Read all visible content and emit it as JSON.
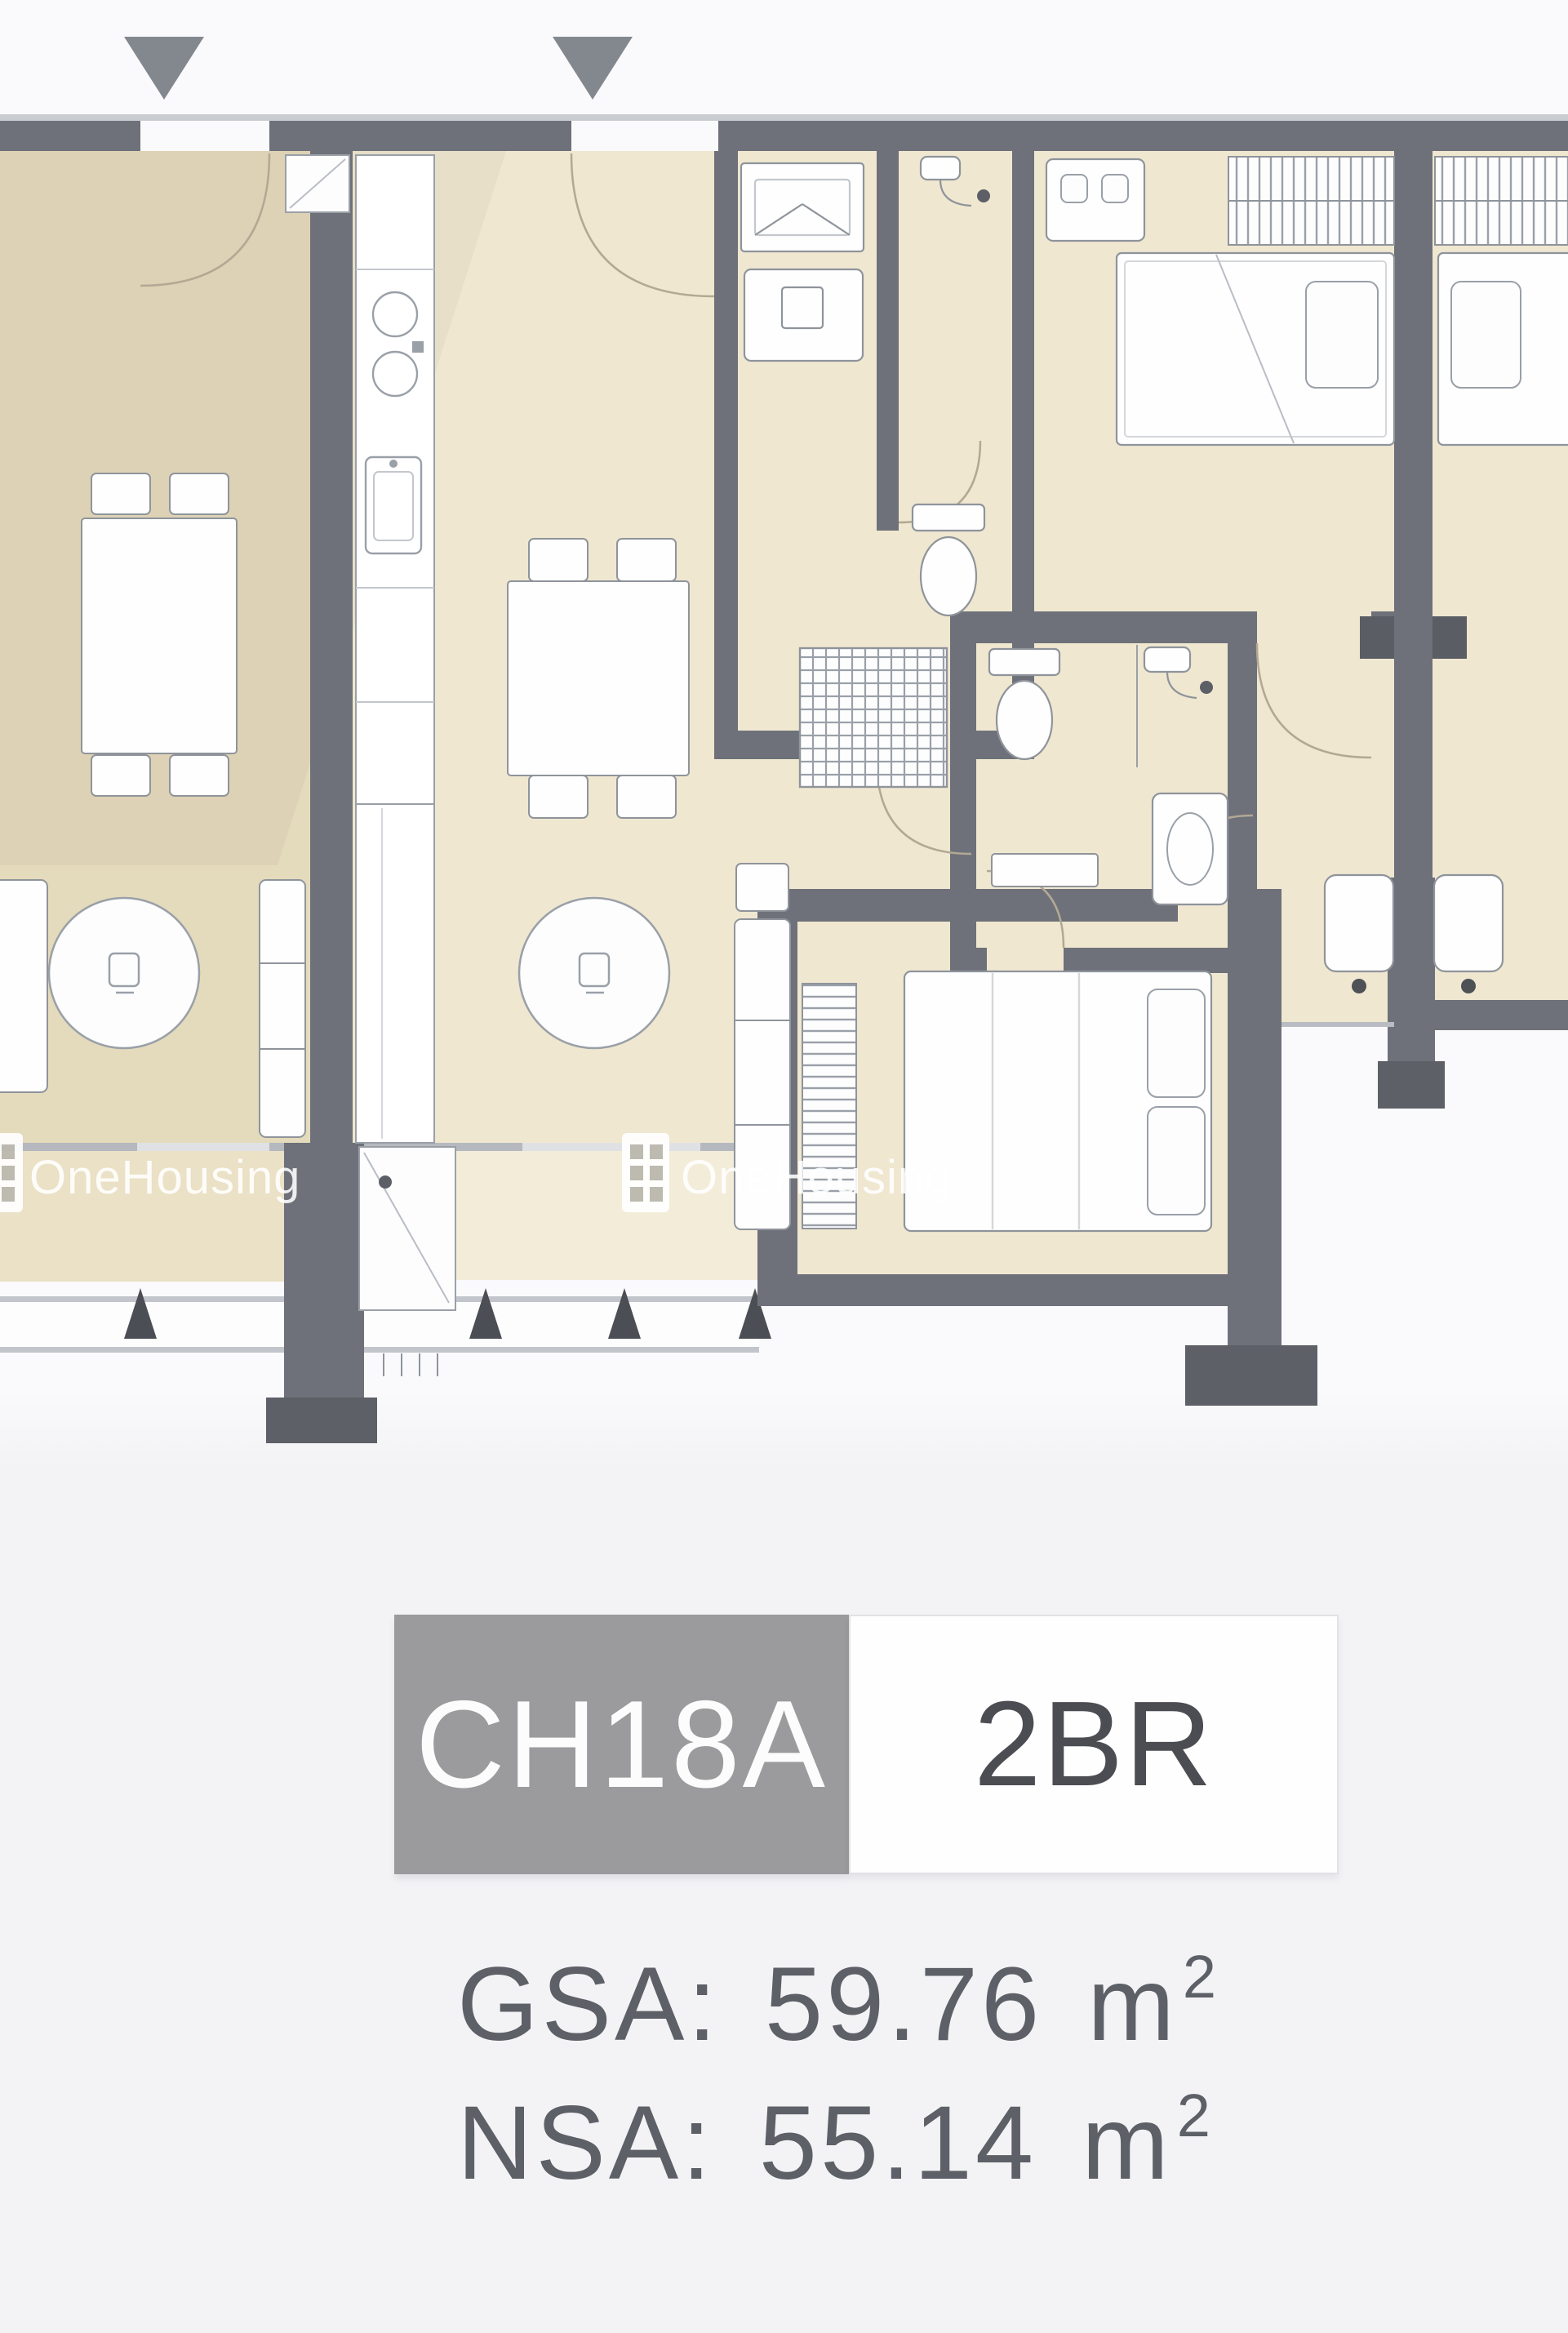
{
  "page": {
    "background": "#f3f3f6"
  },
  "plan": {
    "watermarks": [
      {
        "text": "OneHousing"
      },
      {
        "text": "OneHousing"
      }
    ],
    "colors": {
      "wall": "#6e7179",
      "room_main": "#efe7d0",
      "room_dim": "#e4dabc",
      "balcony": "#f2ecd9",
      "entrance_marker": "#83878e",
      "label_gray": "#9b9a9c",
      "label_text_dark": "#4b4d53",
      "area_text": "#5d6066"
    }
  },
  "label": {
    "unit_code": "CH18A",
    "unit_type": "2BR"
  },
  "areas": {
    "gsa_label": "GSA:",
    "gsa_value": "59.76",
    "nsa_label": "NSA:",
    "nsa_value": "55.14",
    "unit_base": "m",
    "unit_exponent": "2"
  }
}
